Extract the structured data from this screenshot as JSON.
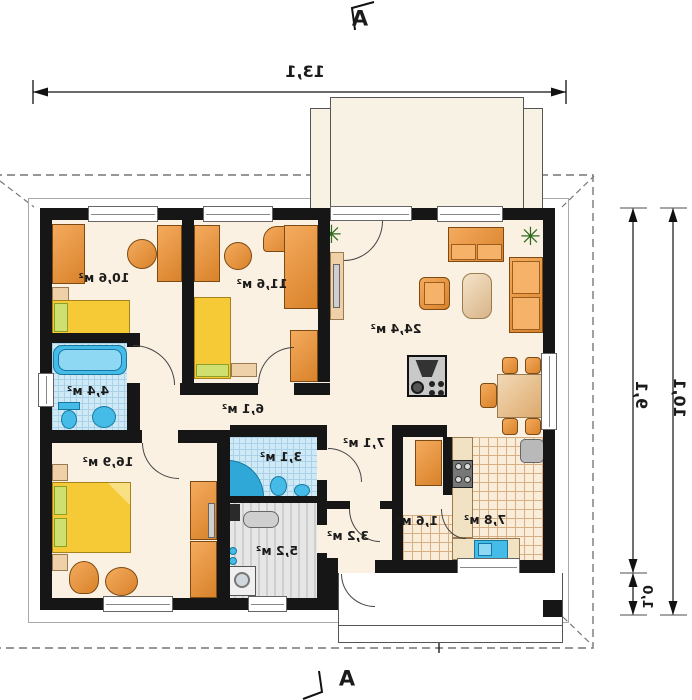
{
  "plan_type": "house-floor-plan",
  "orientation": "mirrored",
  "markers": {
    "top": "A",
    "bottom": "A"
  },
  "dimensions": {
    "width_top": "13,1",
    "height_inner": "9,1",
    "height_outer": "10,1",
    "offset_bottom": "1,0"
  },
  "rooms": [
    {
      "name": "room-1",
      "area": "10,6 м²"
    },
    {
      "name": "room-2",
      "area": "11,6 м²"
    },
    {
      "name": "living-room",
      "area": "24,4 м²"
    },
    {
      "name": "bathroom",
      "area": "4,4 м²"
    },
    {
      "name": "hall",
      "area": "6,1 м²"
    },
    {
      "name": "bedroom",
      "area": "16,9 м²"
    },
    {
      "name": "shower-room",
      "area": "3,1 м²"
    },
    {
      "name": "corridor",
      "area": "7,1 м²"
    },
    {
      "name": "utility-room",
      "area": "5,2 м²"
    },
    {
      "name": "entry-hall",
      "area": "3,2 м²"
    },
    {
      "name": "pantry",
      "area": "1,6 м²"
    },
    {
      "name": "kitchen",
      "area": "7,8 м²"
    }
  ],
  "icons": {
    "plant": "✳"
  },
  "colors": {
    "wall": "#161616",
    "floor": "#faf1e2",
    "tile_blue": "#cfe9f7",
    "tile_kitchen": "#f9ecd8",
    "furniture_orange": "#e8913b",
    "bed_yellow": "#f6ca36",
    "fixture_blue": "#45bce8"
  }
}
